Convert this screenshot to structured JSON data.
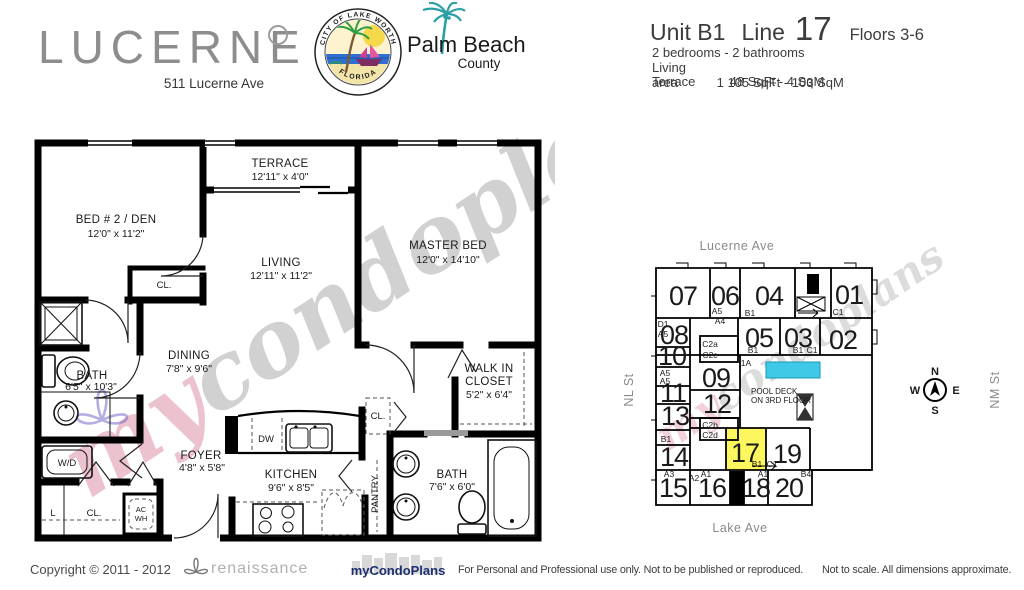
{
  "header": {
    "building_name": "LUCERNE",
    "address": "511 Lucerne Ave",
    "seal_top": "CITY OF LAKE WORTH",
    "seal_bottom": "FLORIDA",
    "county_line1": "Palm Beach",
    "county_line2": "County",
    "unit_title": "Unit B1",
    "line_label": "Line",
    "line_number": "17",
    "floors": "Floors 3-6",
    "beds_baths": "2 bedrooms - 2 bathrooms",
    "living_label": "Living area",
    "living_value": "1 105 SqFt - 103 SqM",
    "terrace_label": "Terrace",
    "terrace_value": "48 SqFt -    4 SqM"
  },
  "floorplan": {
    "rooms": {
      "terrace": {
        "name": "TERRACE",
        "dims": "12'11\" x 4'0\""
      },
      "bed2": {
        "name": "BED # 2 / DEN",
        "dims": "12'0\" x 11'2\""
      },
      "master": {
        "name": "MASTER BED",
        "dims": "12'0\" x 14'10\""
      },
      "living": {
        "name": "LIVING",
        "dims": "12'11\" x 11'2\""
      },
      "dining": {
        "name": "DINING",
        "dims": "7'8\" x 9'6\""
      },
      "bath1": {
        "name": "BATH",
        "dims": "6'5\" x 10'3\""
      },
      "foyer": {
        "name": "FOYER",
        "dims": "4'8\" x 5'8\""
      },
      "kitchen": {
        "name": "KITCHEN",
        "dims": "9'6\" x 8'5\""
      },
      "walkin": {
        "line1": "WALK IN",
        "line2": "CLOSET",
        "dims": "5'2\" x 6'4\""
      },
      "bath2": {
        "name": "BATH",
        "dims": "7'6\" x 6'0\""
      }
    },
    "fixtures": {
      "dw": "DW",
      "wd": "W/D",
      "l": "L",
      "cl_bed2": "CL.",
      "cl_hall": "CL.",
      "cl_entry": "CL.",
      "ac": "AC",
      "wh": "WH",
      "pantry": "PANTRY"
    }
  },
  "watermark": {
    "part1": "my",
    "part2": "condoplans"
  },
  "keyplan": {
    "streets": {
      "top": "Lucerne Ave",
      "bottom": "Lake Ave",
      "left": "NL St",
      "right": "NM St"
    },
    "pool": {
      "line1": "POOL DECK",
      "line2": "ON 3RD FLOOR"
    },
    "compass": {
      "n": "N",
      "e": "E",
      "s": "S",
      "w": "W"
    },
    "highlighted_unit": "17",
    "units": {
      "u07": "07",
      "u06": "06",
      "u04": "04",
      "u01": "01",
      "u05": "05",
      "u03": "03",
      "u02": "02",
      "u08": "08",
      "u09": "09",
      "u10": "10",
      "u11": "11",
      "u12": "12",
      "u13": "13",
      "u14": "14",
      "u15": "15",
      "u16": "16",
      "u17": "17",
      "u18": "18",
      "u19": "19",
      "u20": "20"
    },
    "labels": {
      "a5_06": "A5",
      "b1_04": "B1",
      "c1_01": "C1",
      "d1": "D1",
      "a5_d1": "A5",
      "a4": "A4",
      "c2a": "C2a",
      "c2c": "C2c",
      "b1_05": "B1",
      "b1_03": "B1",
      "c1_03": "C1",
      "a5_s1": "A5",
      "a5_s2": "A5",
      "l1a": "1A",
      "c2b": "C2b",
      "c2d": "C2d",
      "b1_13": "B1",
      "b1_17": "B1",
      "c1_19": "C1",
      "a3": "A3",
      "a2": "A2",
      "a1_16": "A1",
      "a1_18": "A1",
      "b4": "B4"
    }
  },
  "footer": {
    "copyright": "Copyright © 2011 - 2012",
    "renaissance": "renaissance",
    "brand": "myCondoPlans",
    "usage": "For Personal and Professional use only.  Not to be published or reproduced.",
    "disclaimer": "Not to scale.  All dimensions approximate."
  }
}
